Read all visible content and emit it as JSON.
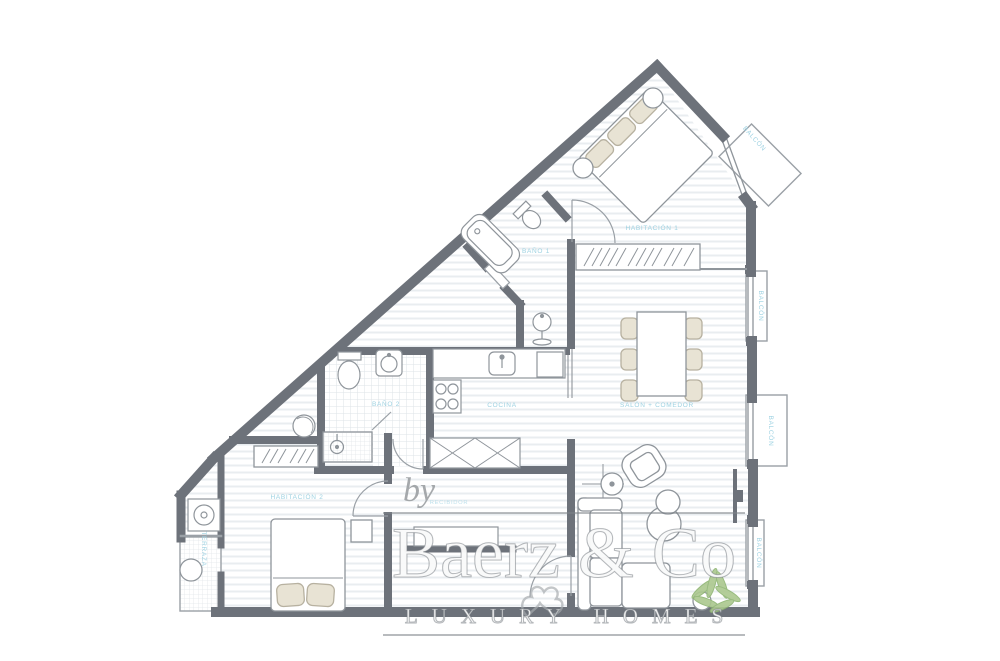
{
  "plan": {
    "labels": {
      "habitacion1": "HABITACIÓN 1",
      "bano1": "BAÑO 1",
      "salon_comedor": "SALÓN + COMEDOR",
      "cocina": "COCINA",
      "bano2": "BAÑO 2",
      "habitacion2": "HABITACIÓN 2",
      "recibidor": "RECIBIDOR",
      "terraza": "TERRAZA",
      "balcon1": "BALCÓN",
      "balcon2": "BALCÓN",
      "balcon3": "BALCÓN",
      "balcon4": "BALCÓN"
    },
    "colors": {
      "wall": "#6d727a",
      "label": "#9ed2e2",
      "furniture": "#8f959b",
      "floor_stripe": "#e9edf0",
      "tile_line": "#dde3e7",
      "cushion": "#e8e3d4",
      "plant": "#a9c98c"
    }
  },
  "watermark": {
    "by": "by",
    "brand": "Baerz & Co",
    "tagline": "LUXURY HOMES"
  }
}
